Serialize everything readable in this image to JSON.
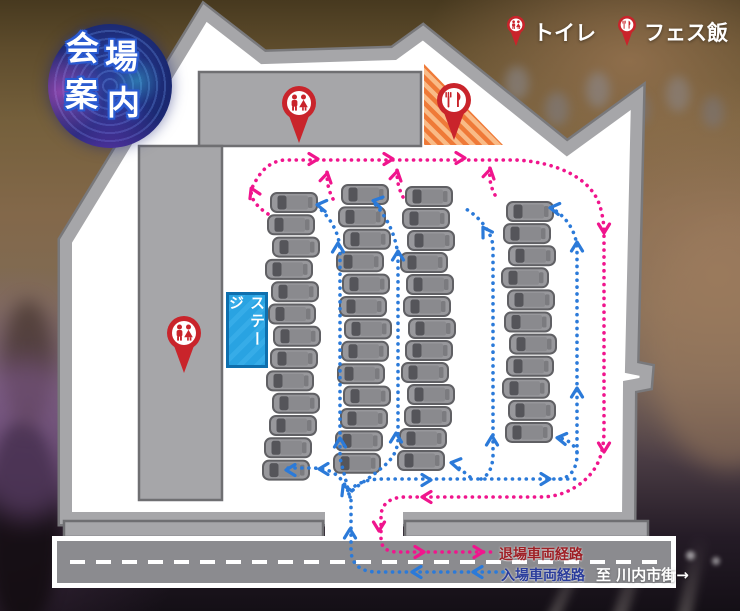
{
  "title_badge": {
    "full": "会場案内",
    "char1": "会",
    "char2": "場",
    "char3": "案",
    "char4": "内"
  },
  "legend": {
    "items": [
      {
        "icon": "toilet-pin-icon",
        "label": "トイレ"
      },
      {
        "icon": "food-pin-icon",
        "label": "フェス飯"
      }
    ]
  },
  "map": {
    "stage_label": "ステージ"
  },
  "road": {
    "exit_route_label": "退場車両経路",
    "entry_route_label": "入場車両経路",
    "destination_label": "至 川内市街→"
  },
  "colors": {
    "exit_route": "#f0158d",
    "entry_route": "#2b7ad9",
    "exit_label": "#9e2026",
    "entry_label": "#2b3d9c",
    "pin_red": "#c9242b",
    "stage_blue": "#29a3e2",
    "stage_border": "#0e6fae",
    "food_area_orange": "#ef7a38",
    "food_area_orange_light": "#f9bb87",
    "map_gray": "#a6a6a9",
    "map_gray_dark": "#79797c",
    "road_gray": "#8b8b8f"
  },
  "parking": {
    "total_cars": 50,
    "columns": [
      {
        "x": 271,
        "y": 193,
        "count": 13,
        "spacing": 22.3
      },
      {
        "x": 342,
        "y": 185,
        "count": 13,
        "spacing": 22.4
      },
      {
        "x": 406,
        "y": 187,
        "count": 13,
        "spacing": 22.0
      },
      {
        "x": 507,
        "y": 202,
        "count": 11,
        "spacing": 22.1
      }
    ]
  }
}
